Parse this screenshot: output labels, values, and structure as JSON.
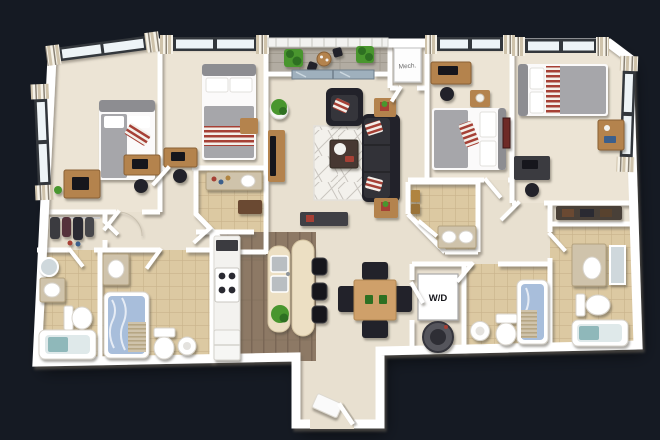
{
  "scene": {
    "type": "3d-floorplan-render",
    "description": "Top-down 3D rendering of a four-bedroom, four-bathroom apartment floor plan on a dark navy background"
  },
  "labels": {
    "mech": "Mech.",
    "wd": "W/D"
  },
  "rooms": [
    {
      "name": "bedroom-1",
      "furniture": [
        "bed",
        "dresser",
        "desk",
        "office-chair",
        "window-curtains"
      ]
    },
    {
      "name": "bedroom-2",
      "furniture": [
        "bed",
        "desk",
        "office-chair",
        "window-curtains"
      ]
    },
    {
      "name": "bedroom-3",
      "furniture": [
        "desk",
        "office-chair",
        "nightstand",
        "bed",
        "wall-art"
      ]
    },
    {
      "name": "bedroom-4",
      "furniture": [
        "bed",
        "desk",
        "computer-desk",
        "closet-shelf",
        "window-curtains"
      ]
    },
    {
      "name": "living-room",
      "furniture": [
        "sofa",
        "armchair",
        "coffee-table",
        "rug",
        "tv-stand",
        "end-tables",
        "plants",
        "console"
      ]
    },
    {
      "name": "balcony",
      "furniture": [
        "planters",
        "bistro-set",
        "sliding-glass-door"
      ]
    },
    {
      "name": "kitchen",
      "furniture": [
        "counter",
        "stove",
        "fridge",
        "island-with-sinks",
        "bar-stools",
        "plant"
      ]
    },
    {
      "name": "dining-area",
      "furniture": [
        "dining-table",
        "dining-chairs"
      ]
    },
    {
      "name": "mech-closet",
      "furniture": [
        "water-heater"
      ]
    },
    {
      "name": "laundry-closet",
      "furniture": [
        "stacked-washer-dryer"
      ]
    },
    {
      "name": "walk-in-closet",
      "furniture": [
        "hanging-clothes"
      ]
    },
    {
      "name": "bathroom-left-1",
      "furniture": [
        "vanity-mirror",
        "sink",
        "toilet",
        "bathtub"
      ]
    },
    {
      "name": "bathroom-left-2",
      "furniture": [
        "vanity",
        "shower-curtain-tub",
        "toilet",
        "pedestal-sink"
      ]
    },
    {
      "name": "bathroom-mid-left",
      "furniture": [
        "vanity-bottles",
        "bench"
      ]
    },
    {
      "name": "bathroom-mid-right",
      "furniture": [
        "canisters",
        "double-sink-vanity"
      ]
    },
    {
      "name": "bathroom-right-1",
      "furniture": [
        "pedestal-sink",
        "toilet",
        "shower-curtain-tub"
      ]
    },
    {
      "name": "bathroom-right-2",
      "furniture": [
        "vanity",
        "mirror",
        "toilet",
        "bathtub"
      ]
    },
    {
      "name": "entry-vestibule",
      "furniture": [
        "front-door",
        "door-mat"
      ]
    }
  ],
  "colors": {
    "background": "#151a23",
    "wall": "#ffffff",
    "floorMain": "#e8e0d0",
    "floorBedroom": "#ece4d5",
    "tile": "#dcc9a2",
    "grout": "#c9b38c",
    "wood": "#8d7965",
    "woodDark": "#7a6756",
    "deck": "#b2aca2",
    "deckLine": "#a09a8f",
    "counter": "#f3f2ef",
    "island": "#ecdfc3",
    "tableWood": "#cfa06b",
    "furnWood": "#b4834e",
    "dark": "#242429",
    "darker": "#19191d",
    "gray": "#9c9c9f",
    "bedWhite": "#fbfafa",
    "blanket": "#a6a6aa",
    "headboard": "#8d8d91",
    "accentRed": "#a63f35",
    "green": "#49962f",
    "greenDark": "#2f7022",
    "teal": "#8fb8ba",
    "curtainBlue": "#a8bedb",
    "rug": "#f3f1ec",
    "rugLine": "#c9c5bf",
    "glass": "#eef4f7",
    "frameDark": "#33373c",
    "curtainTan": "#cfc3ab",
    "curtainCream": "#f6f2e8",
    "steel": "#b9bec2"
  }
}
